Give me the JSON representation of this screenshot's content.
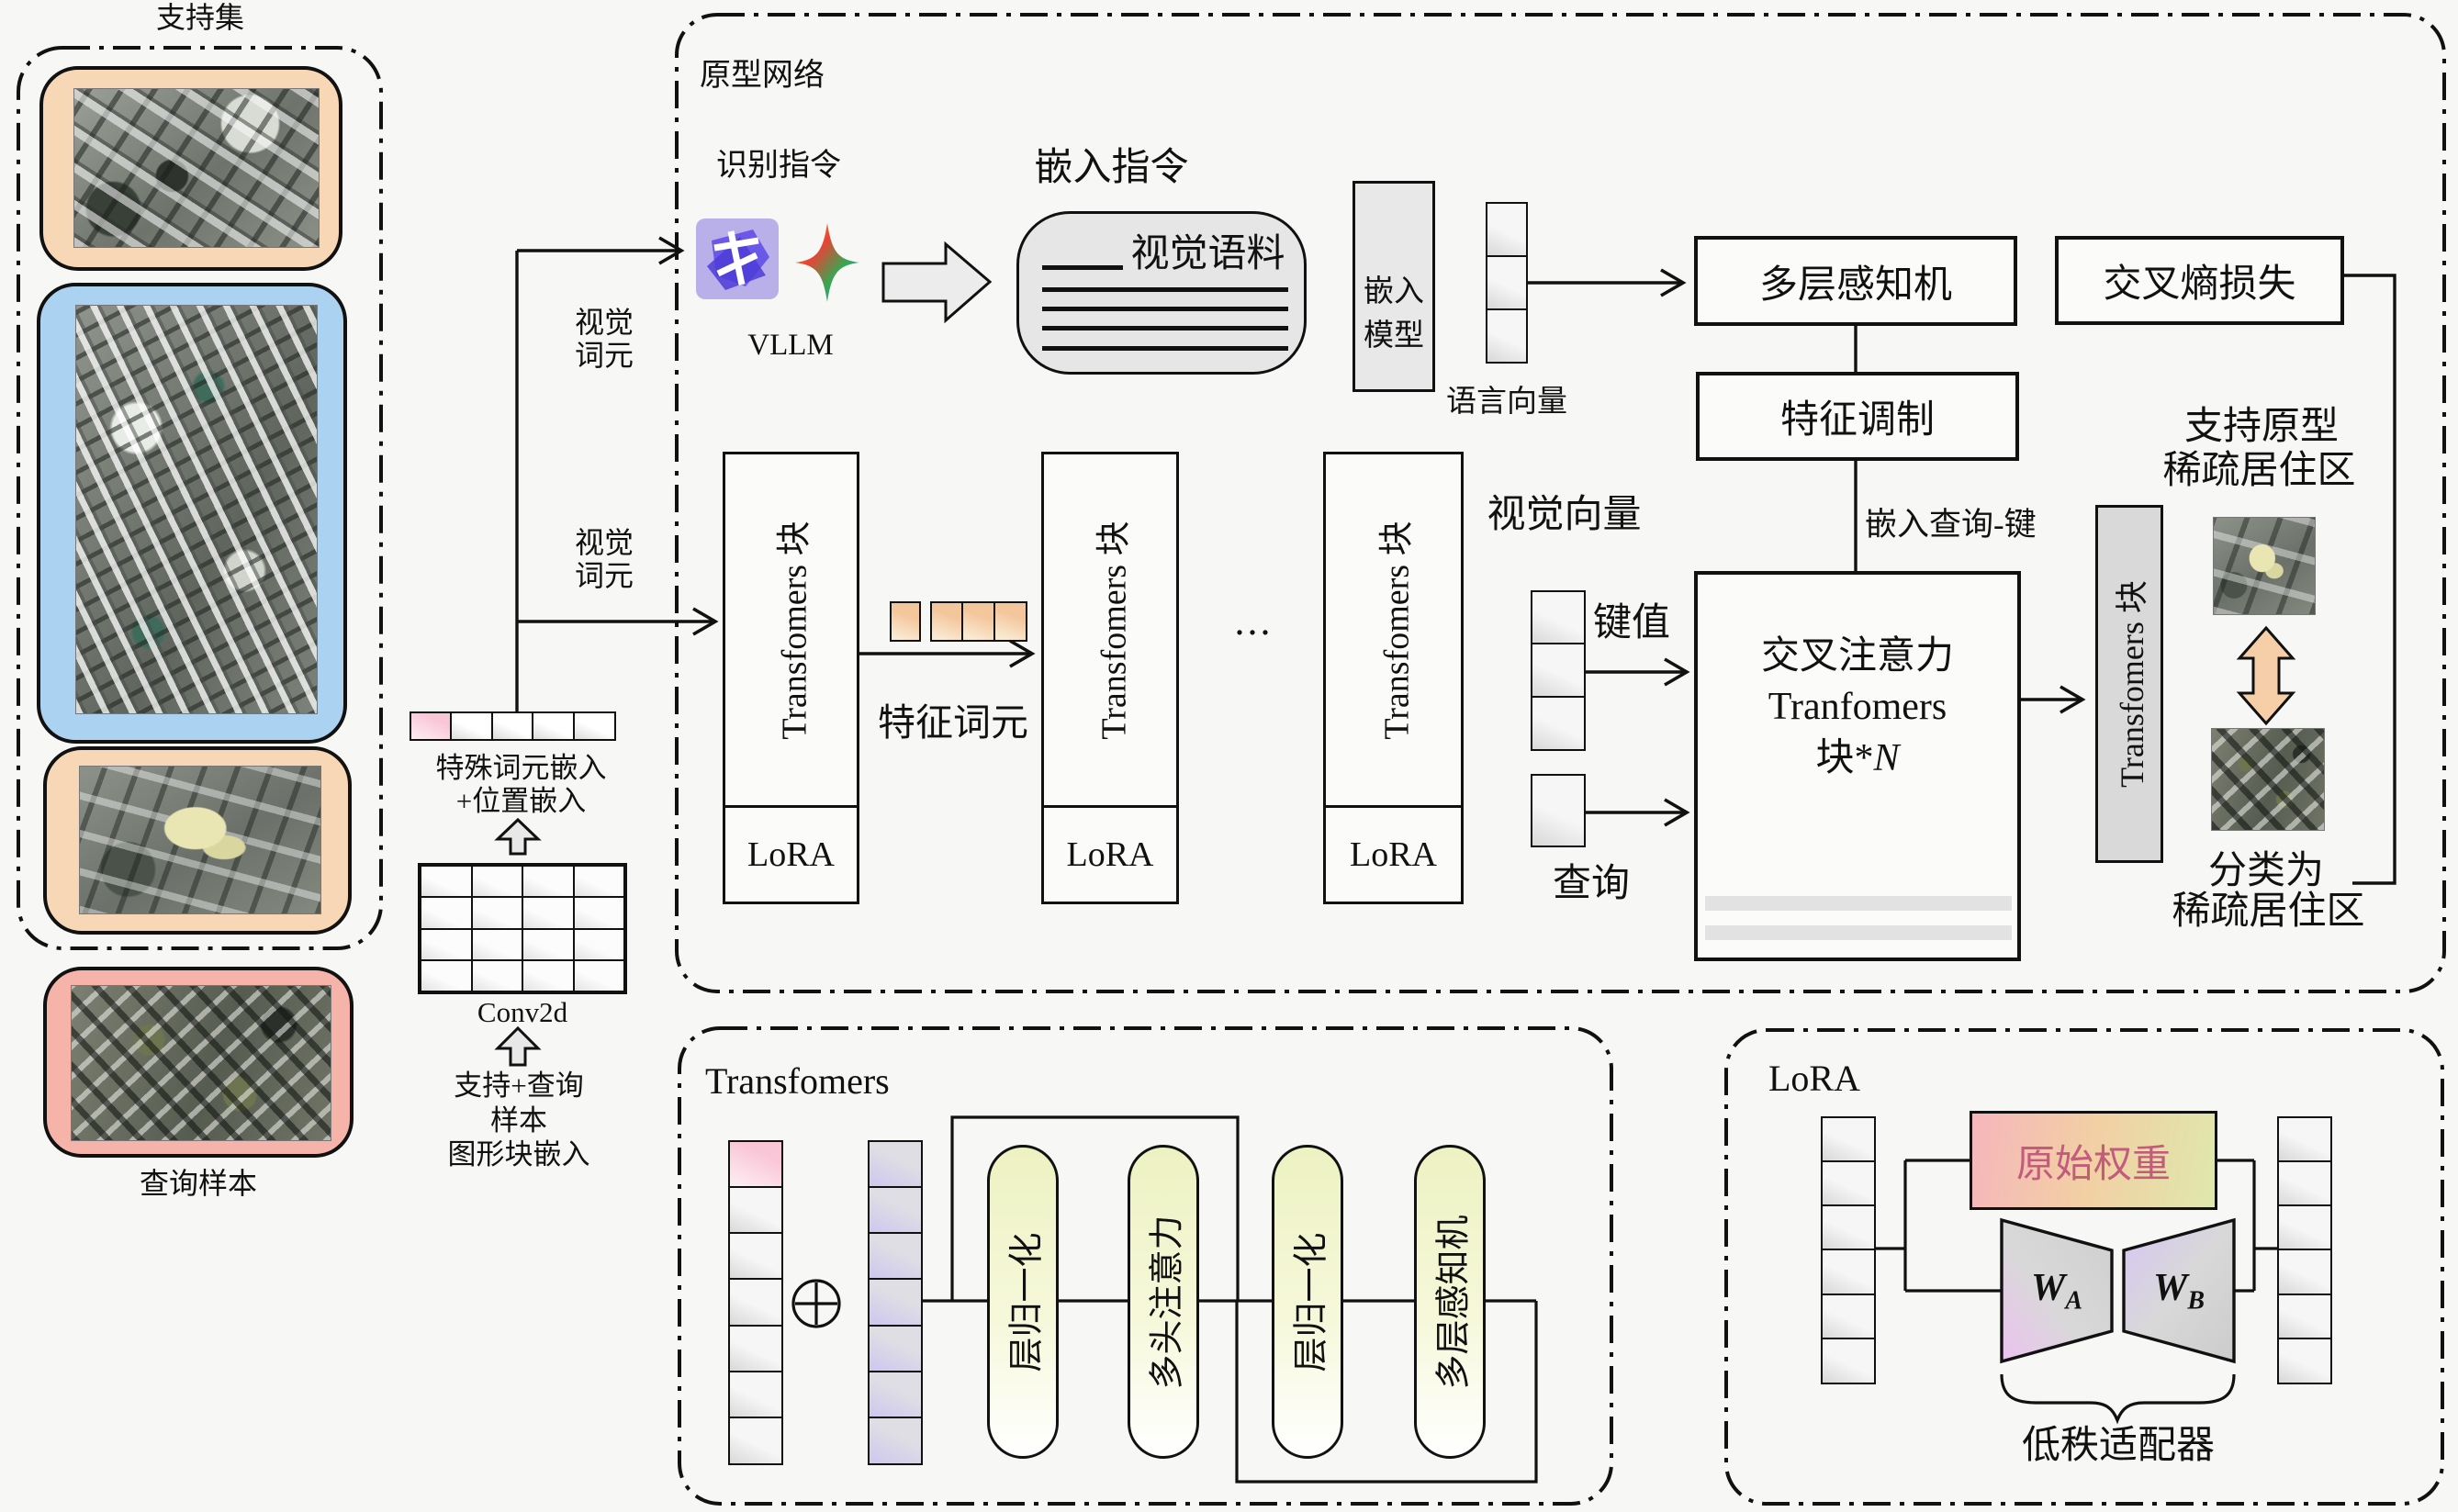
{
  "support_set": {
    "title": "支持集",
    "query_label": "查询样本"
  },
  "embed_pipeline": {
    "special_token_label": "特殊词元嵌入",
    "pos_label": "+位置嵌入",
    "conv_label": "Conv2d",
    "src_line1": "支持+查询",
    "src_line2": "样本",
    "src_line3": "图形块嵌入"
  },
  "visual_token_label_top": {
    "line1": "视觉",
    "line2": "词元"
  },
  "visual_token_label_mid": {
    "line1": "视觉",
    "line2": "词元"
  },
  "prototype_network": {
    "title": "原型网络",
    "recognition_instruction": "识别指令",
    "vllm_label": "VLLM",
    "embedding_instruction": "嵌入指令",
    "visual_corpus": "视觉语料",
    "embed_model": {
      "line1": "嵌入",
      "line2": "模型"
    },
    "language_vector_label": "语言向量",
    "mlp_box": "多层感知机",
    "ce_loss_box": "交叉熵损失",
    "feature_modulation_box": "特征调制",
    "embed_query_key_label": "嵌入查询-键",
    "visual_vector_label": "视觉向量",
    "kv_label": "键值",
    "query_label": "查询",
    "cross_attention": {
      "line1": "交叉注意力",
      "line2": "Tranfomers",
      "line3_prefix": "块*",
      "line3_n": "N"
    },
    "feature_token_label": "特征词元",
    "ellipsis": "...",
    "transformer_blocks": [
      {
        "label": "Transfomers 块",
        "lora": "LoRA"
      },
      {
        "label": "Transfomers 块",
        "lora": "LoRA"
      },
      {
        "label": "Transfomers 块",
        "lora": "LoRA"
      }
    ],
    "output_block_label": "Transfomers 块",
    "support_prototype": {
      "line1": "支持原型",
      "line2": "稀疏居住区"
    },
    "classified": {
      "line1": "分类为",
      "line2": "稀疏居住区"
    }
  },
  "transformer_detail": {
    "title": "Transfomers",
    "pills": [
      "层归一化",
      "多头注意力",
      "层归一化",
      "多层感知机"
    ]
  },
  "lora_detail": {
    "title": "LoRA",
    "original_weight": "原始权重",
    "wa_main": "W",
    "wa_sub": "A",
    "wb_main": "W",
    "wb_sub": "B",
    "brace_label": "低秩适配器"
  },
  "colors": {
    "card_orange": "#f7d7b5",
    "card_blue": "#acd2f2",
    "card_pink": "#f5b3aa",
    "token_pink": "#f9c6d8",
    "pill_yellow": "#edf2c2",
    "peach_arrow": "#f6cfa8",
    "logo_purple": "#5b4be0",
    "weight_text": "#c25b7c"
  }
}
